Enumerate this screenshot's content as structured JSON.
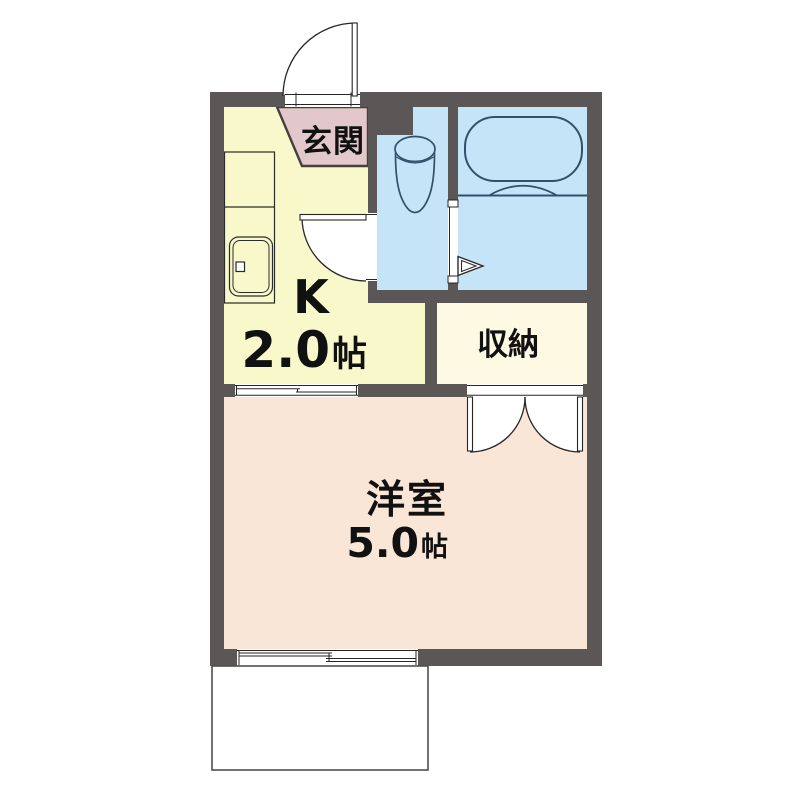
{
  "rooms": {
    "genkan": {
      "label": "玄関"
    },
    "kitchen": {
      "label": "K",
      "area": "2.0",
      "area_unit": "帖"
    },
    "storage": {
      "label": "収納"
    },
    "western_room": {
      "label": "洋室",
      "area": "5.0",
      "area_unit": "帖"
    }
  },
  "colors": {
    "wall": "#5b5757",
    "kitchen_fill": "#f8f8cb",
    "genkan_fill": "#e2c8ca",
    "wet_area_fill": "#c6e4f7",
    "storage_fill": "#fdf9e3",
    "western_room_fill": "#fae6d7",
    "fixture_line": "#33506b",
    "door_line": "#262626",
    "balcony_line": "#4f4f4f"
  }
}
